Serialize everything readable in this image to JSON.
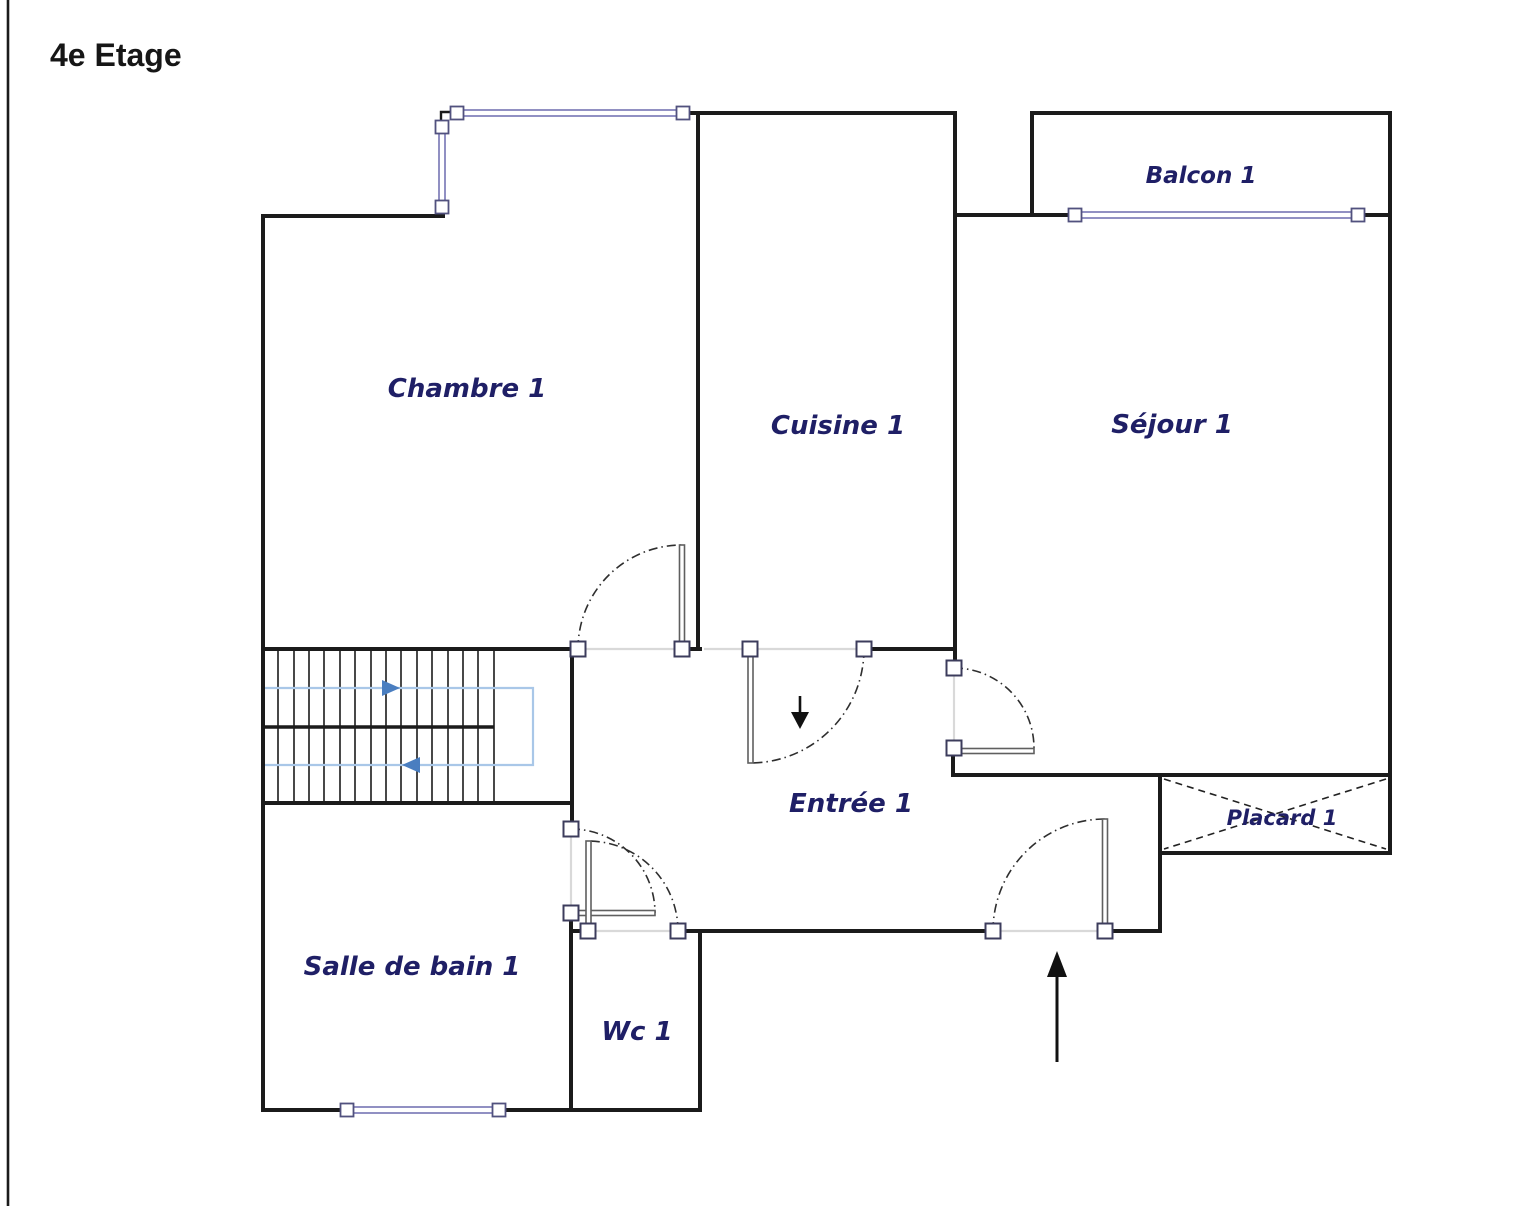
{
  "page": {
    "title": "4e Etage"
  },
  "colors": {
    "background": "#ffffff",
    "wall": "#1b1b1b",
    "label": "#1f1f66",
    "window": "#7674b4",
    "leaf": "#5f5f5f",
    "opening": "#d9d9d9",
    "stair_path": "#a9c7e8",
    "stair_arrow": "#4a7ec0"
  },
  "rooms": [
    {
      "name": "chambre",
      "label": "Chambre 1"
    },
    {
      "name": "cuisine",
      "label": "Cuisine 1"
    },
    {
      "name": "sejour",
      "label": "Séjour 1"
    },
    {
      "name": "balcon",
      "label": "Balcon 1"
    },
    {
      "name": "entree",
      "label": "Entrée 1"
    },
    {
      "name": "salle-de-bain",
      "label": "Salle de bain 1"
    },
    {
      "name": "wc",
      "label": "Wc 1"
    },
    {
      "name": "placard",
      "label": "Placard 1"
    }
  ],
  "annotations": {
    "stair_up_icon": "right-arrow",
    "stair_down_icon": "left-arrow",
    "hall_direction_icon": "down-arrow",
    "entry_direction_icon": "up-arrow",
    "window_count": 4,
    "door_count": 6
  }
}
